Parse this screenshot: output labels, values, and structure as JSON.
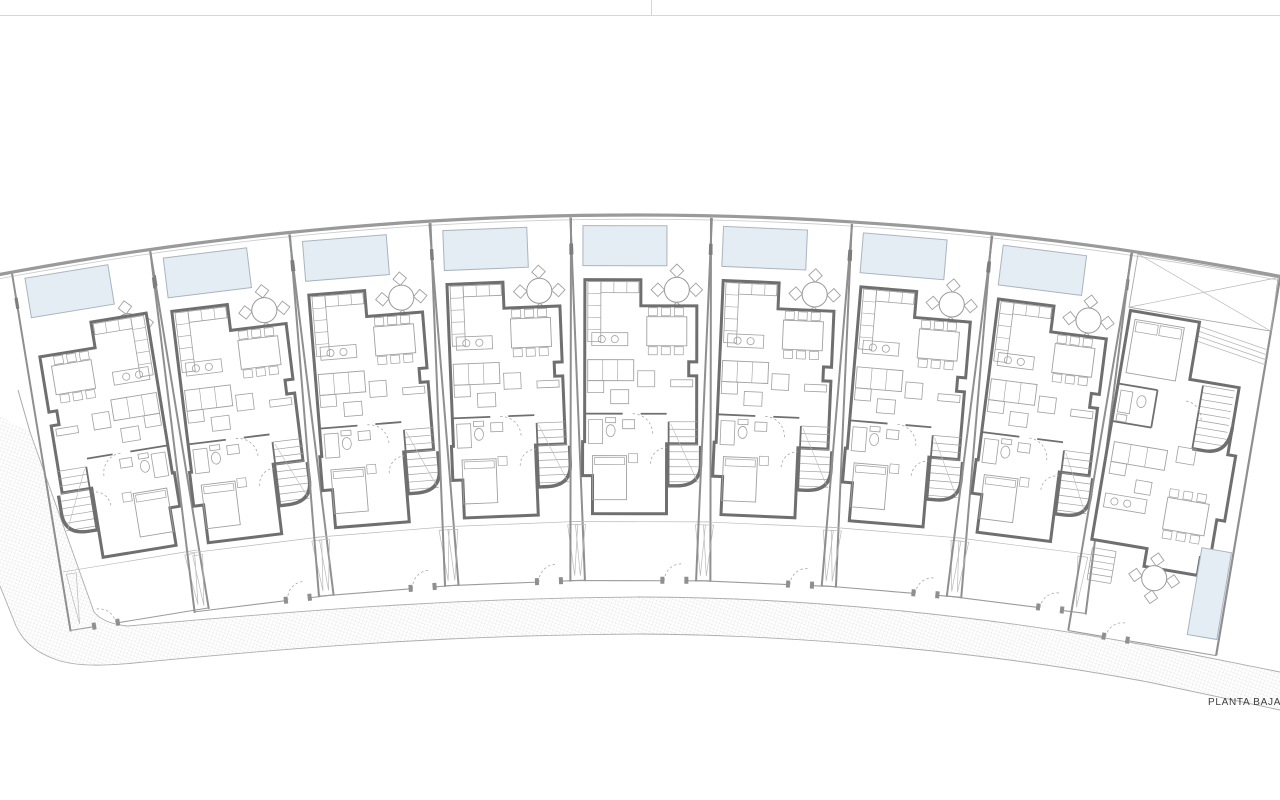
{
  "page": {
    "width_px": 1280,
    "height_px": 800,
    "top_border_y": 15,
    "top_divider_x": 651
  },
  "title": {
    "text": "PLANTA BAJA",
    "x": 1208,
    "y": 697
  },
  "colors": {
    "paper": "#ffffff",
    "wall": "#6f6f6f",
    "wall_medium": "#8f8f8f",
    "lot_line": "#9a9a9a",
    "lot_line_thin": "#c9c9c9",
    "furniture_line": "#a0a0a0",
    "light_line": "#b9b9b9",
    "fence": "#9b9b9b",
    "pool_fill": "#e4ecf4",
    "pool_stroke": "#aab4bf",
    "stipple": "#cfcfcf",
    "page_line": "#d6d6d6",
    "text": "#3c3c3c"
  },
  "site": {
    "arc": {
      "cx": 635,
      "cy": 3637,
      "r": 3422,
      "deg_start": -10.9,
      "deg_end": 11.1,
      "inner_offset": 4.2
    },
    "walkway_fill": "M0,416 L30,432 L94,612 Q104,624 128,626 C330,608 470,598 640,597 C810,597 1000,618 1150,646 L1280,672 L1280,710 L1148,682 C1000,654 810,635 640,634 C470,635 330,644 134,663 Q76,669 52,658 Q26,648 16,626 L0,586 Z",
    "walkway_inner_edge": "M30,432 L94,612 Q104,624 128,626 C330,608 470,598 640,597 C810,597 1000,618 1150,646 L1280,672",
    "walkway_outer_edge": "M0,586 L16,626 Q26,648 52,658 Q76,669 134,663 C330,644 470,635 640,634 C810,635 1000,654 1148,682 L1280,710",
    "left_boundary": {
      "x1": 18,
      "y1": 390,
      "x2": 30,
      "y2": 432
    }
  },
  "units": [
    {
      "id": "unit-1",
      "variant": "row",
      "mirrored": true,
      "x": 11.5,
      "y": 270.3,
      "rot": -9.3,
      "w": 140,
      "features": [
        "pool",
        "patio-table",
        "kitchen",
        "dining-table",
        "sofa",
        "bathroom",
        "stairs",
        "bedroom",
        "front-yard",
        "gate"
      ]
    },
    {
      "id": "unit-2",
      "variant": "row",
      "mirrored": false,
      "x": 150.1,
      "y": 249.6,
      "rot": -7.0,
      "w": 140,
      "features": [
        "pool",
        "patio-table",
        "kitchen",
        "dining-table",
        "sofa",
        "bathroom",
        "stairs",
        "bedroom",
        "front-yard",
        "gate"
      ]
    },
    {
      "id": "unit-3",
      "variant": "row",
      "mirrored": false,
      "x": 289.7,
      "y": 232.4,
      "rot": -4.6,
      "w": 140,
      "features": [
        "pool",
        "patio-table",
        "kitchen",
        "dining-table",
        "sofa",
        "bathroom",
        "stairs",
        "bedroom",
        "front-yard",
        "gate"
      ]
    },
    {
      "id": "unit-4",
      "variant": "row",
      "mirrored": false,
      "x": 430.4,
      "y": 221.1,
      "rot": -2.3,
      "w": 140,
      "features": [
        "pool",
        "patio-table",
        "kitchen",
        "dining-table",
        "sofa",
        "bathroom",
        "stairs",
        "bedroom",
        "front-yard",
        "gate"
      ]
    },
    {
      "id": "unit-5",
      "variant": "row",
      "mirrored": false,
      "x": 571.0,
      "y": 215.6,
      "rot": 0.1,
      "w": 140,
      "features": [
        "pool",
        "patio-table",
        "kitchen",
        "dining-table",
        "sofa",
        "bathroom",
        "stairs",
        "bedroom",
        "front-yard",
        "gate"
      ]
    },
    {
      "id": "unit-6",
      "variant": "row",
      "mirrored": false,
      "x": 712.0,
      "y": 215.9,
      "rot": 2.5,
      "w": 140,
      "features": [
        "pool",
        "patio-table",
        "kitchen",
        "dining-table",
        "sofa",
        "bathroom",
        "stairs",
        "bedroom",
        "front-yard",
        "gate"
      ]
    },
    {
      "id": "unit-7",
      "variant": "row",
      "mirrored": false,
      "x": 852.3,
      "y": 221.9,
      "rot": 4.8,
      "w": 140,
      "features": [
        "pool",
        "patio-table",
        "kitchen",
        "dining-table",
        "sofa",
        "bathroom",
        "stairs",
        "bedroom",
        "front-yard",
        "gate"
      ]
    },
    {
      "id": "unit-8",
      "variant": "row",
      "mirrored": false,
      "x": 992.6,
      "y": 233.8,
      "rot": 7.2,
      "w": 140,
      "features": [
        "pool",
        "patio-table",
        "kitchen",
        "dining-table",
        "sofa",
        "bathroom",
        "stairs",
        "bedroom",
        "front-yard",
        "gate"
      ]
    },
    {
      "id": "unit-9",
      "variant": "end",
      "mirrored": false,
      "x": 1132.6,
      "y": 250.0,
      "rot": 9.6,
      "w": 150,
      "features": [
        "carport",
        "bedroom",
        "pergola",
        "bathroom",
        "stairs",
        "sofa",
        "kitchen",
        "dining-table",
        "patio-table",
        "rear-pool",
        "garden-stairs",
        "gate"
      ]
    }
  ]
}
